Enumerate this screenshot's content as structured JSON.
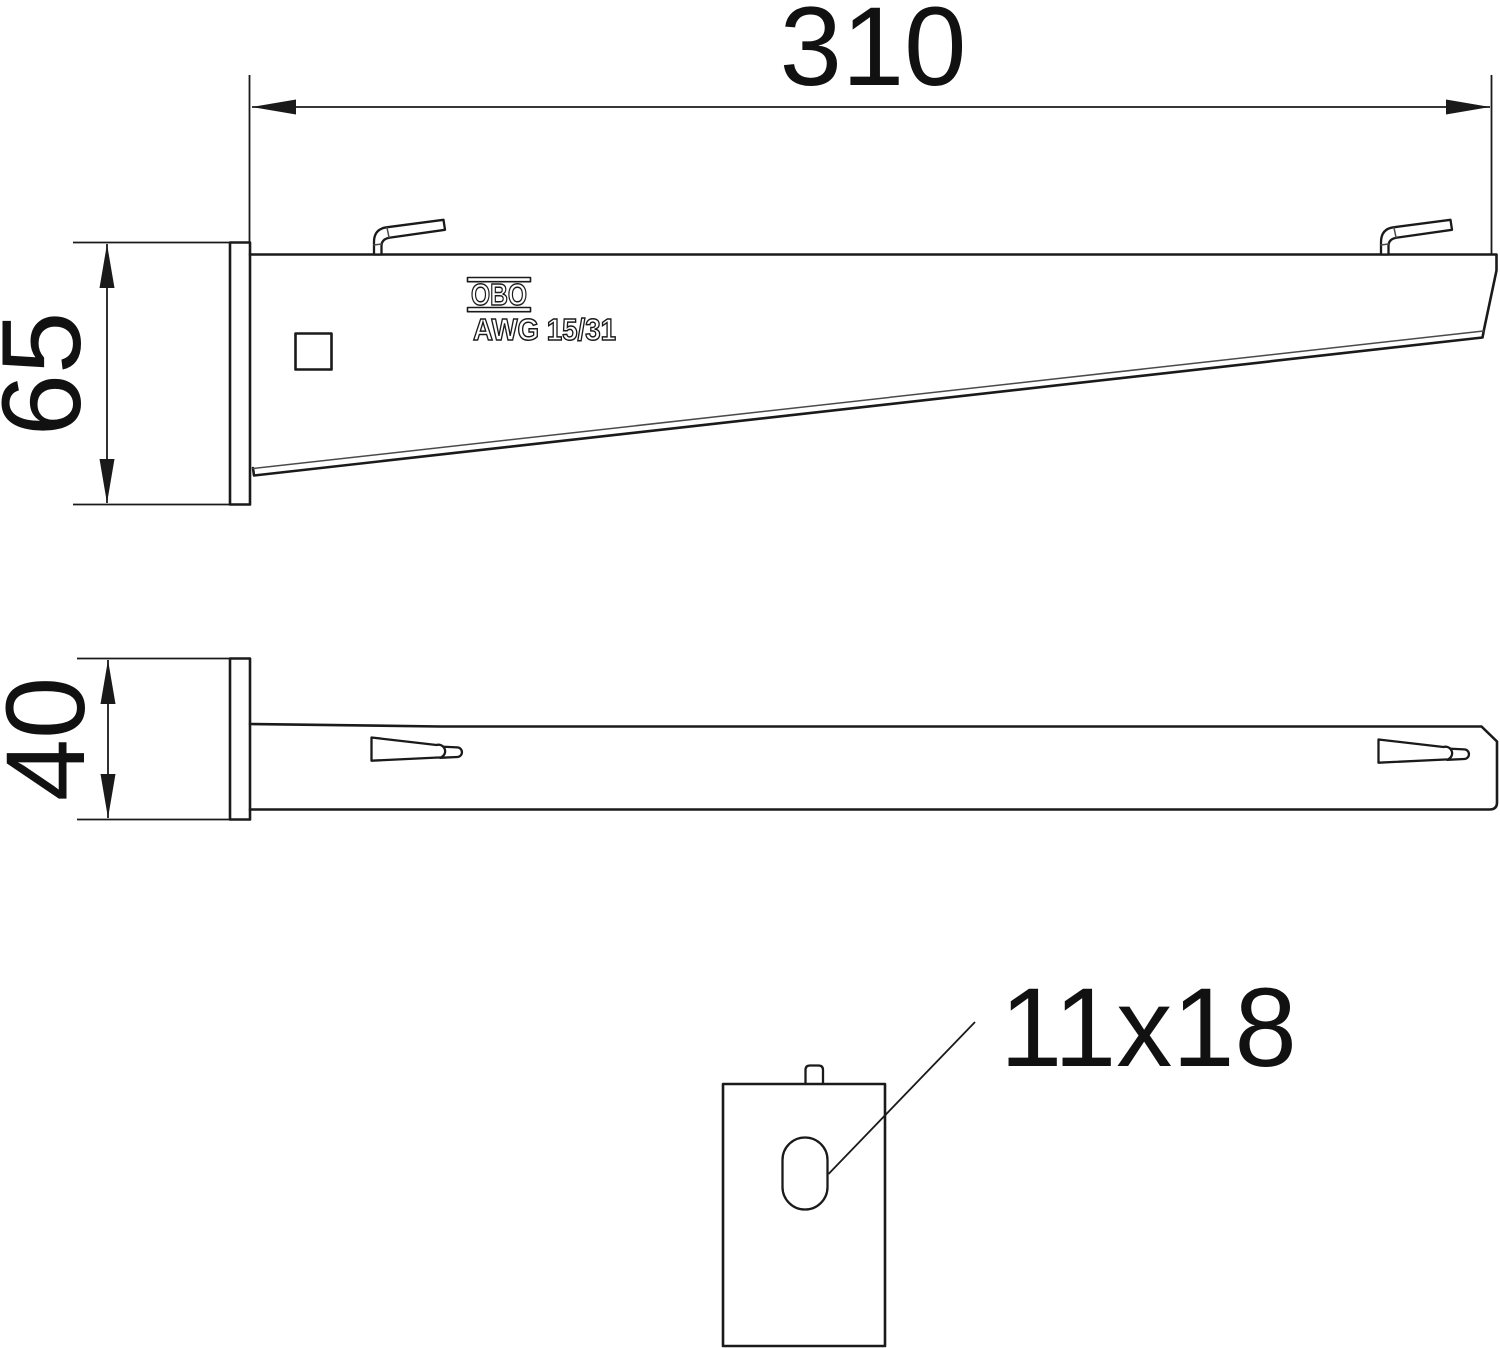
{
  "canvas": {
    "background": "#ffffff",
    "line_color": "#1a1a1a"
  },
  "branding": {
    "logo": "OBO",
    "model": "AWG 15/31"
  },
  "dimensions": {
    "arm_length": "310",
    "plate_height": "65",
    "plate_width": "40",
    "slot_size": "11x18"
  },
  "icons": {
    "dimension_arrow": "filled-triangle-arrowhead"
  }
}
